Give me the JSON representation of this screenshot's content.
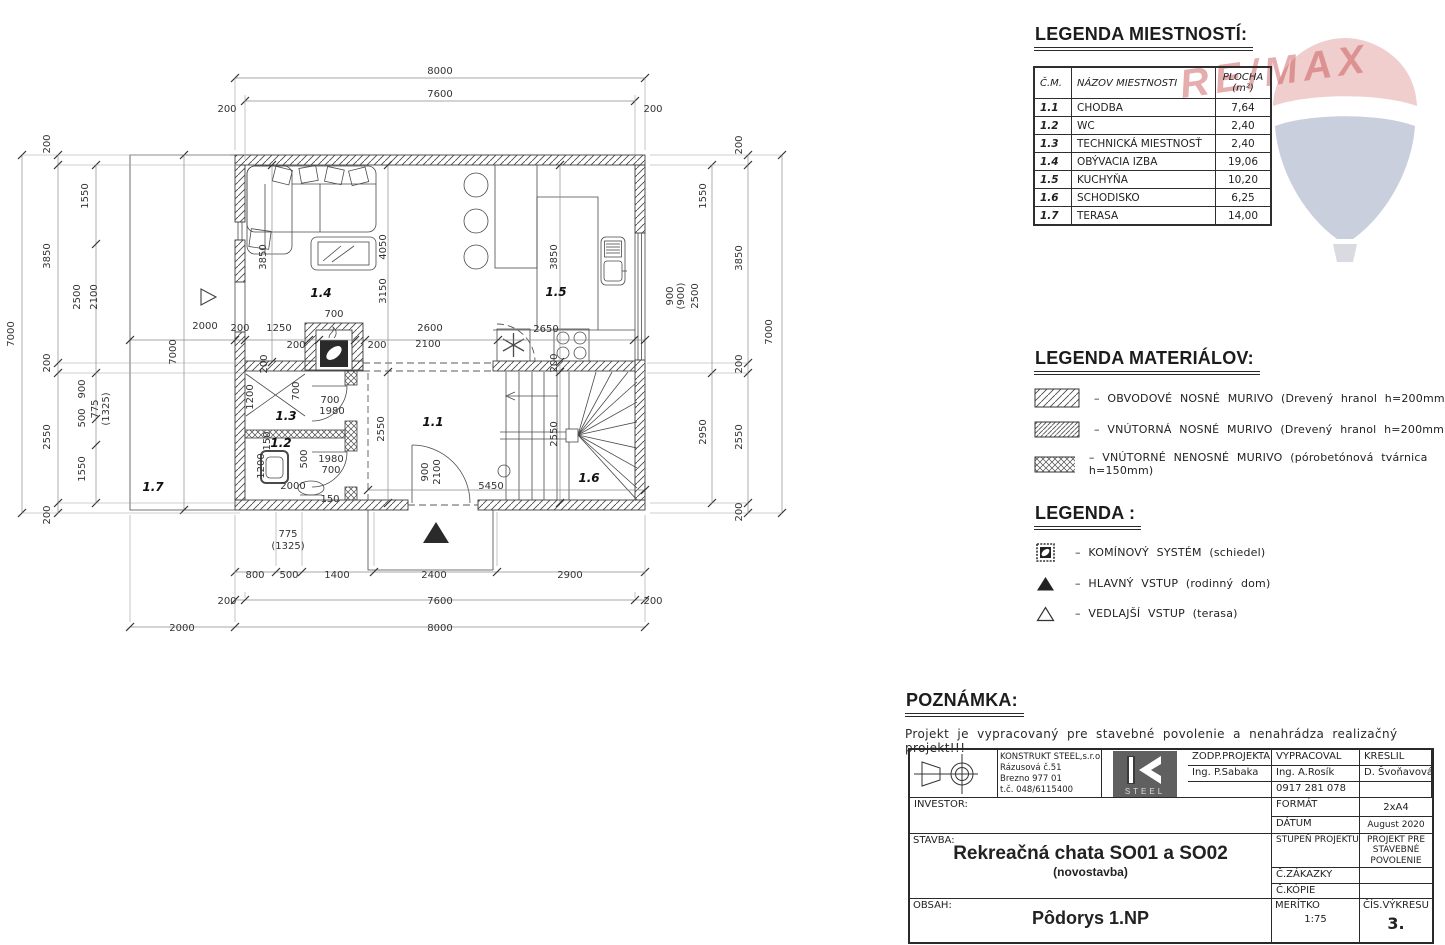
{
  "room_legend": {
    "title": "LEGENDA MIESTNOSTÍ:",
    "headers": {
      "num": "Č.M.",
      "name": "NÁZOV MIESTNOSTI",
      "area_1": "PLOCHA",
      "area_2": "(m²)"
    },
    "rows": [
      {
        "num": "1.1",
        "name": "CHODBA",
        "area": "7,64"
      },
      {
        "num": "1.2",
        "name": "WC",
        "area": "2,40"
      },
      {
        "num": "1.3",
        "name": "TECHNICKÁ MIESTNOSŤ",
        "area": "2,40"
      },
      {
        "num": "1.4",
        "name": "OBÝVACIA IZBA",
        "area": "19,06"
      },
      {
        "num": "1.5",
        "name": "KUCHYŇA",
        "area": "10,20"
      },
      {
        "num": "1.6",
        "name": "SCHODISKO",
        "area": "6,25"
      },
      {
        "num": "1.7",
        "name": "TERASA",
        "area": "14,00"
      }
    ]
  },
  "material_legend": {
    "title": "LEGENDA MATERIÁLOV:",
    "items": [
      {
        "icon": "hatch-outer-wall",
        "label": "–  OBVODOVÉ NOSNÉ MURIVO (Drevený hranol h=200mm)"
      },
      {
        "icon": "hatch-inner-wall",
        "label": "–  VNÚTORNÁ NOSNÉ MURIVO (Drevený hranol h=200mm)"
      },
      {
        "icon": "crosshatch-partition",
        "label": "–  VNÚTORNÉ NENOSNÉ MURIVO (pórobetónová tvárnica h=150mm)"
      }
    ]
  },
  "symbol_legend": {
    "title": "LEGENDA :",
    "items": [
      {
        "icon": "chimney-icon",
        "label": "–  KOMÍNOVÝ SYSTÉM (schiedel)"
      },
      {
        "icon": "filled-triangle-icon",
        "label": "–  HLAVNÝ VSTUP (rodinný dom)"
      },
      {
        "icon": "open-triangle-icon",
        "label": "–  VEDLAJŠÍ VSTUP (terasa)"
      }
    ]
  },
  "note": {
    "title": "POZNÁMKA:",
    "text": "Projekt je vypracovaný pre stavebné povolenie a nenahrádza realizačný projekt!!!"
  },
  "watermark": {
    "text": "RE/MAX",
    "red": "#c23a3a",
    "blue": "#51618f"
  },
  "title_block": {
    "zodp_label": "ZODP.PROJEKTANT",
    "zodp_name": "Ing.  P.Sabaka",
    "vypracoval_label": "VYPRACOVAL",
    "vypracoval_name": "Ing.  A.Rosík",
    "vypracoval_phone": "0917 281 078",
    "kreslil_label": "KRESLIL",
    "kreslil_name": "D.  Švoňavová",
    "firm_line1": "KONSTRUKT  STEEL,s.r.o.",
    "firm_line2": "Rázusová  č.51",
    "firm_line3": "Brezno  977  01",
    "firm_line4": "t.č.  048/6115400",
    "logo_text": "STEEL",
    "investor_label": "INVESTOR:",
    "format_label": "FORMÁT",
    "format_value": "2xA4",
    "datum_label": "DÁTUM",
    "datum_value": "August  2020",
    "stavba_label": "STAVBA:",
    "stavba_title": "Rekreačná chata SO01 a SO02",
    "stavba_sub": "(novostavba)",
    "stupen_label": "STUPEŇ  PROJEKTU",
    "stupen_value": "PROJEKT  PRE  STAVEBNÉ  POVOLENIE",
    "zakazky_label": "Č.ZÁKAZKY",
    "kopie_label": "Č.KÓPIE",
    "obsah_label": "OBSAH:",
    "obsah_value": "Pôdorys 1.NP",
    "meritko_label": "MERÍTKO",
    "meritko_value": "1:75",
    "cis_label": "ČÍS.VÝKRESU",
    "cis_value": "3."
  },
  "plan": {
    "drawing_name": "Pôdorys 1.NP",
    "rooms": [
      [
        "1.1",
        433,
        426
      ],
      [
        "1.2",
        281,
        447
      ],
      [
        "1.3",
        286,
        420
      ],
      [
        "1.4",
        321,
        297
      ],
      [
        "1.5",
        556,
        296
      ],
      [
        "1.6",
        589,
        482
      ],
      [
        "1.7",
        153,
        491
      ]
    ],
    "dims": [
      [
        "8000",
        440,
        74,
        0
      ],
      [
        "7600",
        440,
        97,
        0
      ],
      [
        "200",
        227,
        112,
        0
      ],
      [
        "200",
        653,
        112,
        0
      ],
      [
        "800",
        255,
        578,
        0
      ],
      [
        "500",
        289,
        578,
        0
      ],
      [
        "1400",
        337,
        578,
        0
      ],
      [
        "2400",
        434,
        578,
        0
      ],
      [
        "2900",
        570,
        578,
        0
      ],
      [
        "200",
        227,
        604,
        0
      ],
      [
        "7600",
        440,
        604,
        0
      ],
      [
        "200",
        653,
        604,
        0
      ],
      [
        "2000",
        182,
        631,
        0
      ],
      [
        "8000",
        440,
        631,
        0
      ],
      [
        "775",
        288,
        537,
        0
      ],
      [
        "(1325)",
        288,
        549,
        0
      ],
      [
        "7000",
        14,
        334,
        1
      ],
      [
        "200",
        50,
        144,
        1
      ],
      [
        "3850",
        50,
        256,
        1
      ],
      [
        "200",
        50,
        363,
        1
      ],
      [
        "2550",
        50,
        437,
        1
      ],
      [
        "200",
        50,
        515,
        1
      ],
      [
        "1550",
        88,
        196,
        1
      ],
      [
        "2500",
        80,
        297,
        1
      ],
      [
        "2100",
        97,
        297,
        1
      ],
      [
        "900",
        85,
        389,
        1
      ],
      [
        "500",
        85,
        418,
        1
      ],
      [
        "775",
        98,
        409,
        1
      ],
      [
        "(1325)",
        109,
        409,
        1
      ],
      [
        "1550",
        85,
        469,
        1
      ],
      [
        "1550",
        706,
        196,
        1
      ],
      [
        "900",
        673,
        296,
        1
      ],
      [
        "(900)",
        684,
        296,
        1
      ],
      [
        "2500",
        698,
        296,
        1
      ],
      [
        "2950",
        706,
        432,
        1
      ],
      [
        "200",
        742,
        145,
        1
      ],
      [
        "3850",
        742,
        258,
        1
      ],
      [
        "200",
        742,
        364,
        1
      ],
      [
        "2550",
        742,
        437,
        1
      ],
      [
        "200",
        742,
        512,
        1
      ],
      [
        "7000",
        772,
        332,
        1
      ],
      [
        "2000",
        205,
        329,
        0
      ],
      [
        "200",
        240,
        331,
        0
      ],
      [
        "1250",
        279,
        331,
        0
      ],
      [
        "700",
        334,
        317,
        0
      ],
      [
        "200",
        296,
        348,
        0
      ],
      [
        "200",
        377,
        348,
        0
      ],
      [
        "2600",
        430,
        331,
        0
      ],
      [
        "2100",
        428,
        347,
        0
      ],
      [
        "2650",
        546,
        332,
        0
      ],
      [
        "7000",
        176,
        352,
        1
      ],
      [
        "3850",
        266,
        257,
        1
      ],
      [
        "4050",
        386,
        247,
        1
      ],
      [
        "3150",
        386,
        291,
        1
      ],
      [
        "3850",
        557,
        257,
        1
      ],
      [
        "1200",
        253,
        397,
        1
      ],
      [
        "700",
        299,
        391,
        1
      ],
      [
        "700",
        330,
        403,
        0
      ],
      [
        "1980",
        332,
        414,
        0
      ],
      [
        "2550",
        384,
        429,
        1
      ],
      [
        "150",
        270,
        441,
        1
      ],
      [
        "500",
        307,
        459,
        1
      ],
      [
        "1980",
        331,
        462,
        0
      ],
      [
        "700",
        331,
        473,
        0
      ],
      [
        "1200",
        264,
        466,
        1
      ],
      [
        "2000",
        293,
        489,
        0
      ],
      [
        "150",
        330,
        502,
        0
      ],
      [
        "900",
        428,
        472,
        1
      ],
      [
        "2100",
        440,
        472,
        1
      ],
      [
        "5450",
        491,
        489,
        0
      ],
      [
        "200",
        557,
        363,
        1
      ],
      [
        "2550",
        557,
        434,
        1
      ],
      [
        "200",
        267,
        364,
        1
      ]
    ]
  }
}
